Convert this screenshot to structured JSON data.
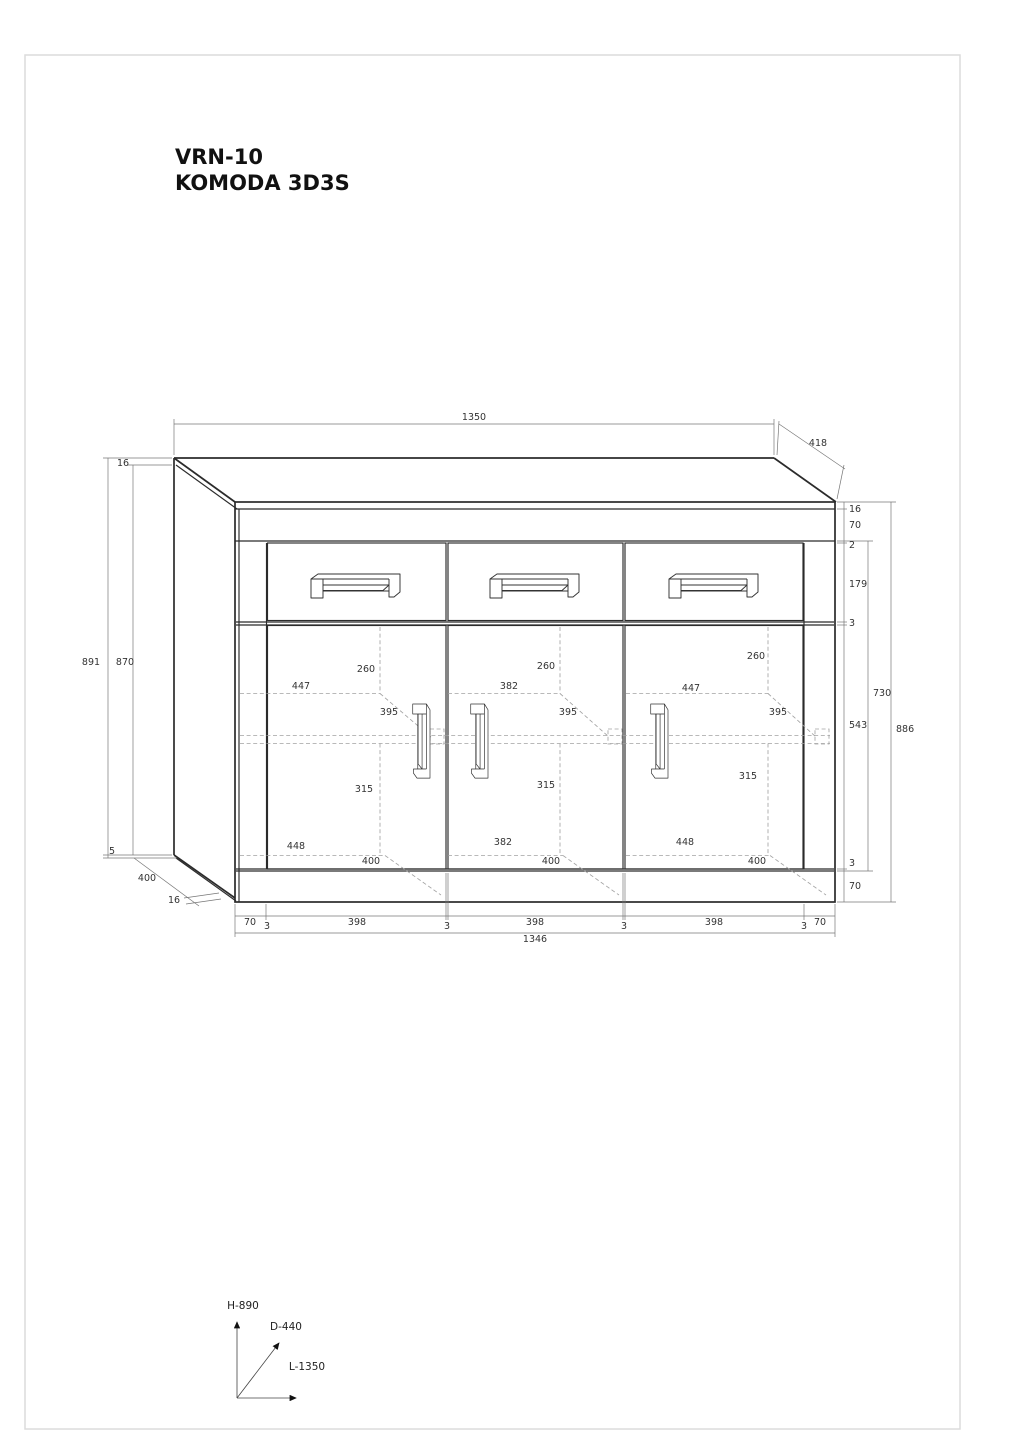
{
  "labels": {
    "title": {
      "line1": "VRN-10",
      "line2": "KOMODA 3D3S"
    },
    "top": {
      "width": "1350",
      "depth": "418"
    },
    "left": {
      "panel": "16",
      "total": "891",
      "front": "870",
      "gap": "5",
      "depth": "400",
      "thickness": "16"
    },
    "right": {
      "r1": "16",
      "r2": "70",
      "r3": "2",
      "r4": "179",
      "r5": "3",
      "inner": "730",
      "door": "543",
      "total": "886",
      "r9": "3",
      "r10": "70"
    },
    "doors": [
      {
        "top": "260",
        "upper": "447",
        "shelf": "395",
        "lower": "315",
        "bottom": "448",
        "depth": "400"
      },
      {
        "top": "260",
        "upper": "382",
        "shelf": "395",
        "lower": "315",
        "bottom": "382",
        "depth": "400"
      },
      {
        "top": "260",
        "upper": "447",
        "shelf": "395",
        "lower": "315",
        "bottom": "448",
        "depth": "400"
      }
    ],
    "bottom": {
      "s1": "70",
      "s2": "3",
      "s3": "398",
      "s4": "3",
      "s5": "398",
      "s6": "3",
      "s7": "398",
      "s8": "3",
      "s9": "70",
      "total": "1346"
    },
    "axes": {
      "h": "H-890",
      "d": "D-440",
      "l": "L-1350"
    }
  }
}
